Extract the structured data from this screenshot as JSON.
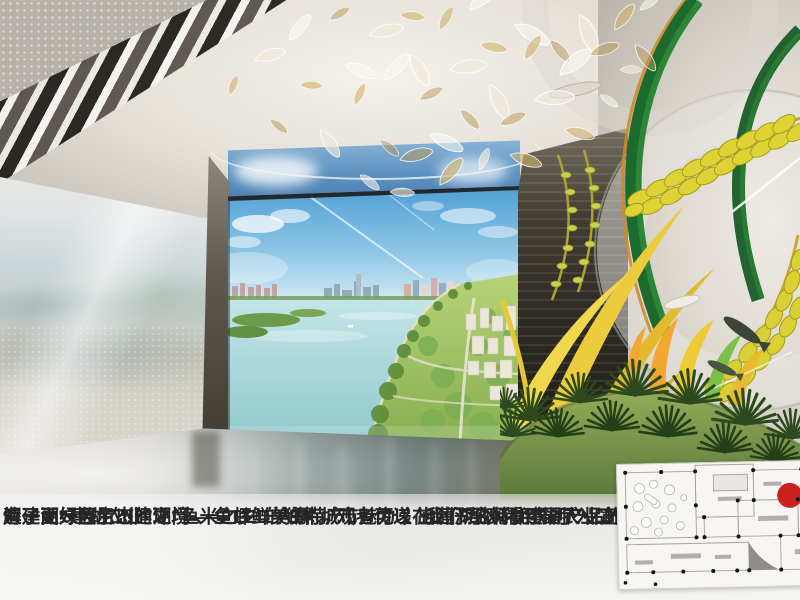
{
  "document": {
    "kind": "exhibition-design-proposal-page"
  },
  "caption": {
    "line1": "为了更好展示出建湖“鱼米之乡”的独特城市魅力 ， 我们巧妙利用展厅入口位置， 创新打",
    "line2": "造一面“建湖农业”之门—— LED 大屏 。观者可以在此仔细观看建湖农业宣传片， 更好了",
    "line3": "解建湖绿色生态的环境 、鱼虾鲜美的特产 ， 传递  出建湖名特优农副产品的品牌特点。"
  },
  "floorplan": {
    "marker_color": "#c8231f"
  },
  "colors": {
    "rice_gold": "#ddd334",
    "stem_green": "#1d6b2c",
    "leaf_yellow": "#eccb3c",
    "screen_sky": "#5e93c2",
    "lake_water": "#a9d8de",
    "floor_teal": "#3d504d",
    "wall_silver": "#cdc9c2",
    "marker_red": "#c8231f"
  },
  "icons": {
    "chandelier": "fish-school-ornament",
    "sculpture": "rice-ear-sculpture",
    "marker": "red-dot-location-marker"
  }
}
